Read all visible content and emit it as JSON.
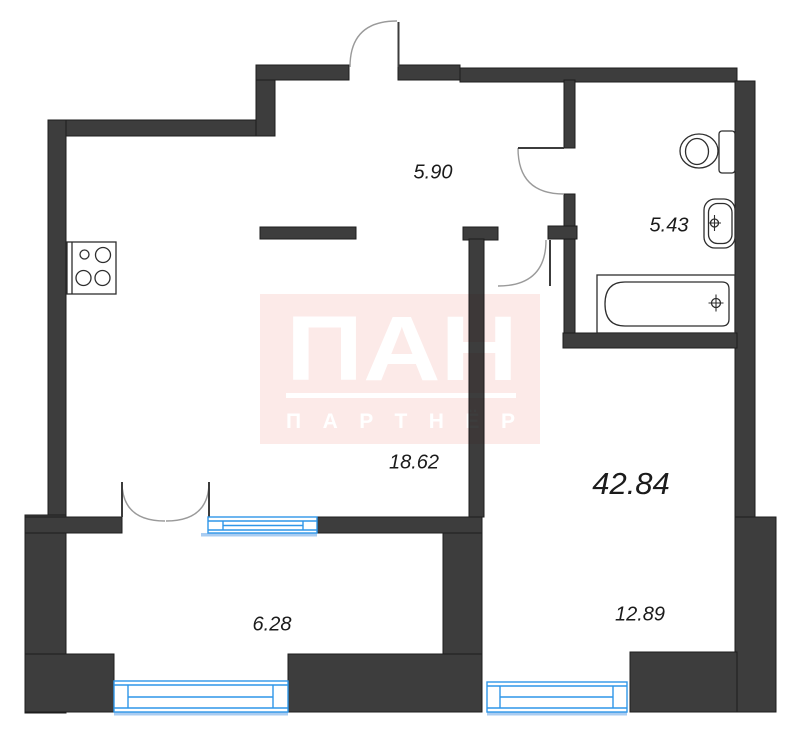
{
  "watermark": {
    "logo": "ПАН",
    "subtitle": "ПАРТНЁР"
  },
  "labels": {
    "hallway_area": "5.90",
    "bathroom_area": "5.43",
    "kitchen_living_area": "18.62",
    "total_area": "42.84",
    "room_area": "12.89",
    "balcony_area": "6.28"
  },
  "colors": {
    "wall": "#3d3d3d",
    "wall_outline": "#1d1d1d",
    "window_blue": "#2f96e8",
    "window_sill_light": "#a9ccf1",
    "fixture_stroke": "#2e2e2e",
    "door_arc": "#9a9a9a",
    "door_leaf": "#3c3c3c",
    "watermark_pink": "#fceae8",
    "label_text": "#1b1b1b"
  }
}
